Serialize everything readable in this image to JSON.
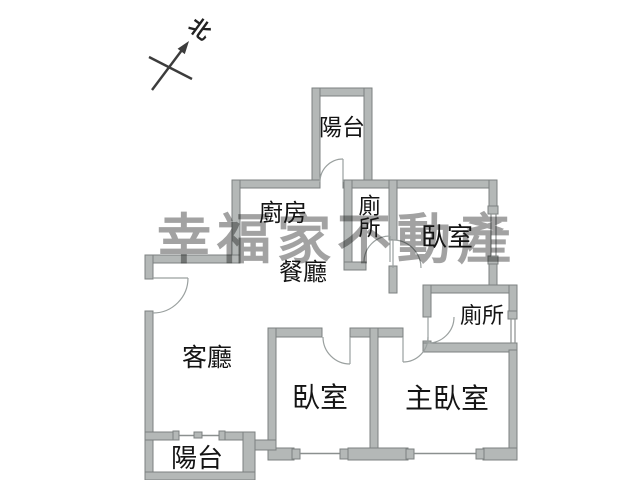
{
  "compass": {
    "label": "北"
  },
  "watermark": {
    "text": "幸福家不動產",
    "color": "#9a9a9a"
  },
  "rooms": {
    "balcony_top": "陽台",
    "kitchen": "廚房",
    "toilet_top": "廁所",
    "bedroom_top": "臥室",
    "dining": "餐廳",
    "toilet_right": "廁所",
    "living": "客廳",
    "bedroom_bottom": "臥室",
    "master_bedroom": "主臥室",
    "balcony_bottom": "陽台"
  },
  "colors": {
    "background": "#ffffff",
    "wall_fill": "#b4b8b7",
    "wall_outline": "#7c8180",
    "label_text": "#141414",
    "watermark_gray": "#9a9a9a",
    "compass_ink": "#3c3c3c"
  }
}
